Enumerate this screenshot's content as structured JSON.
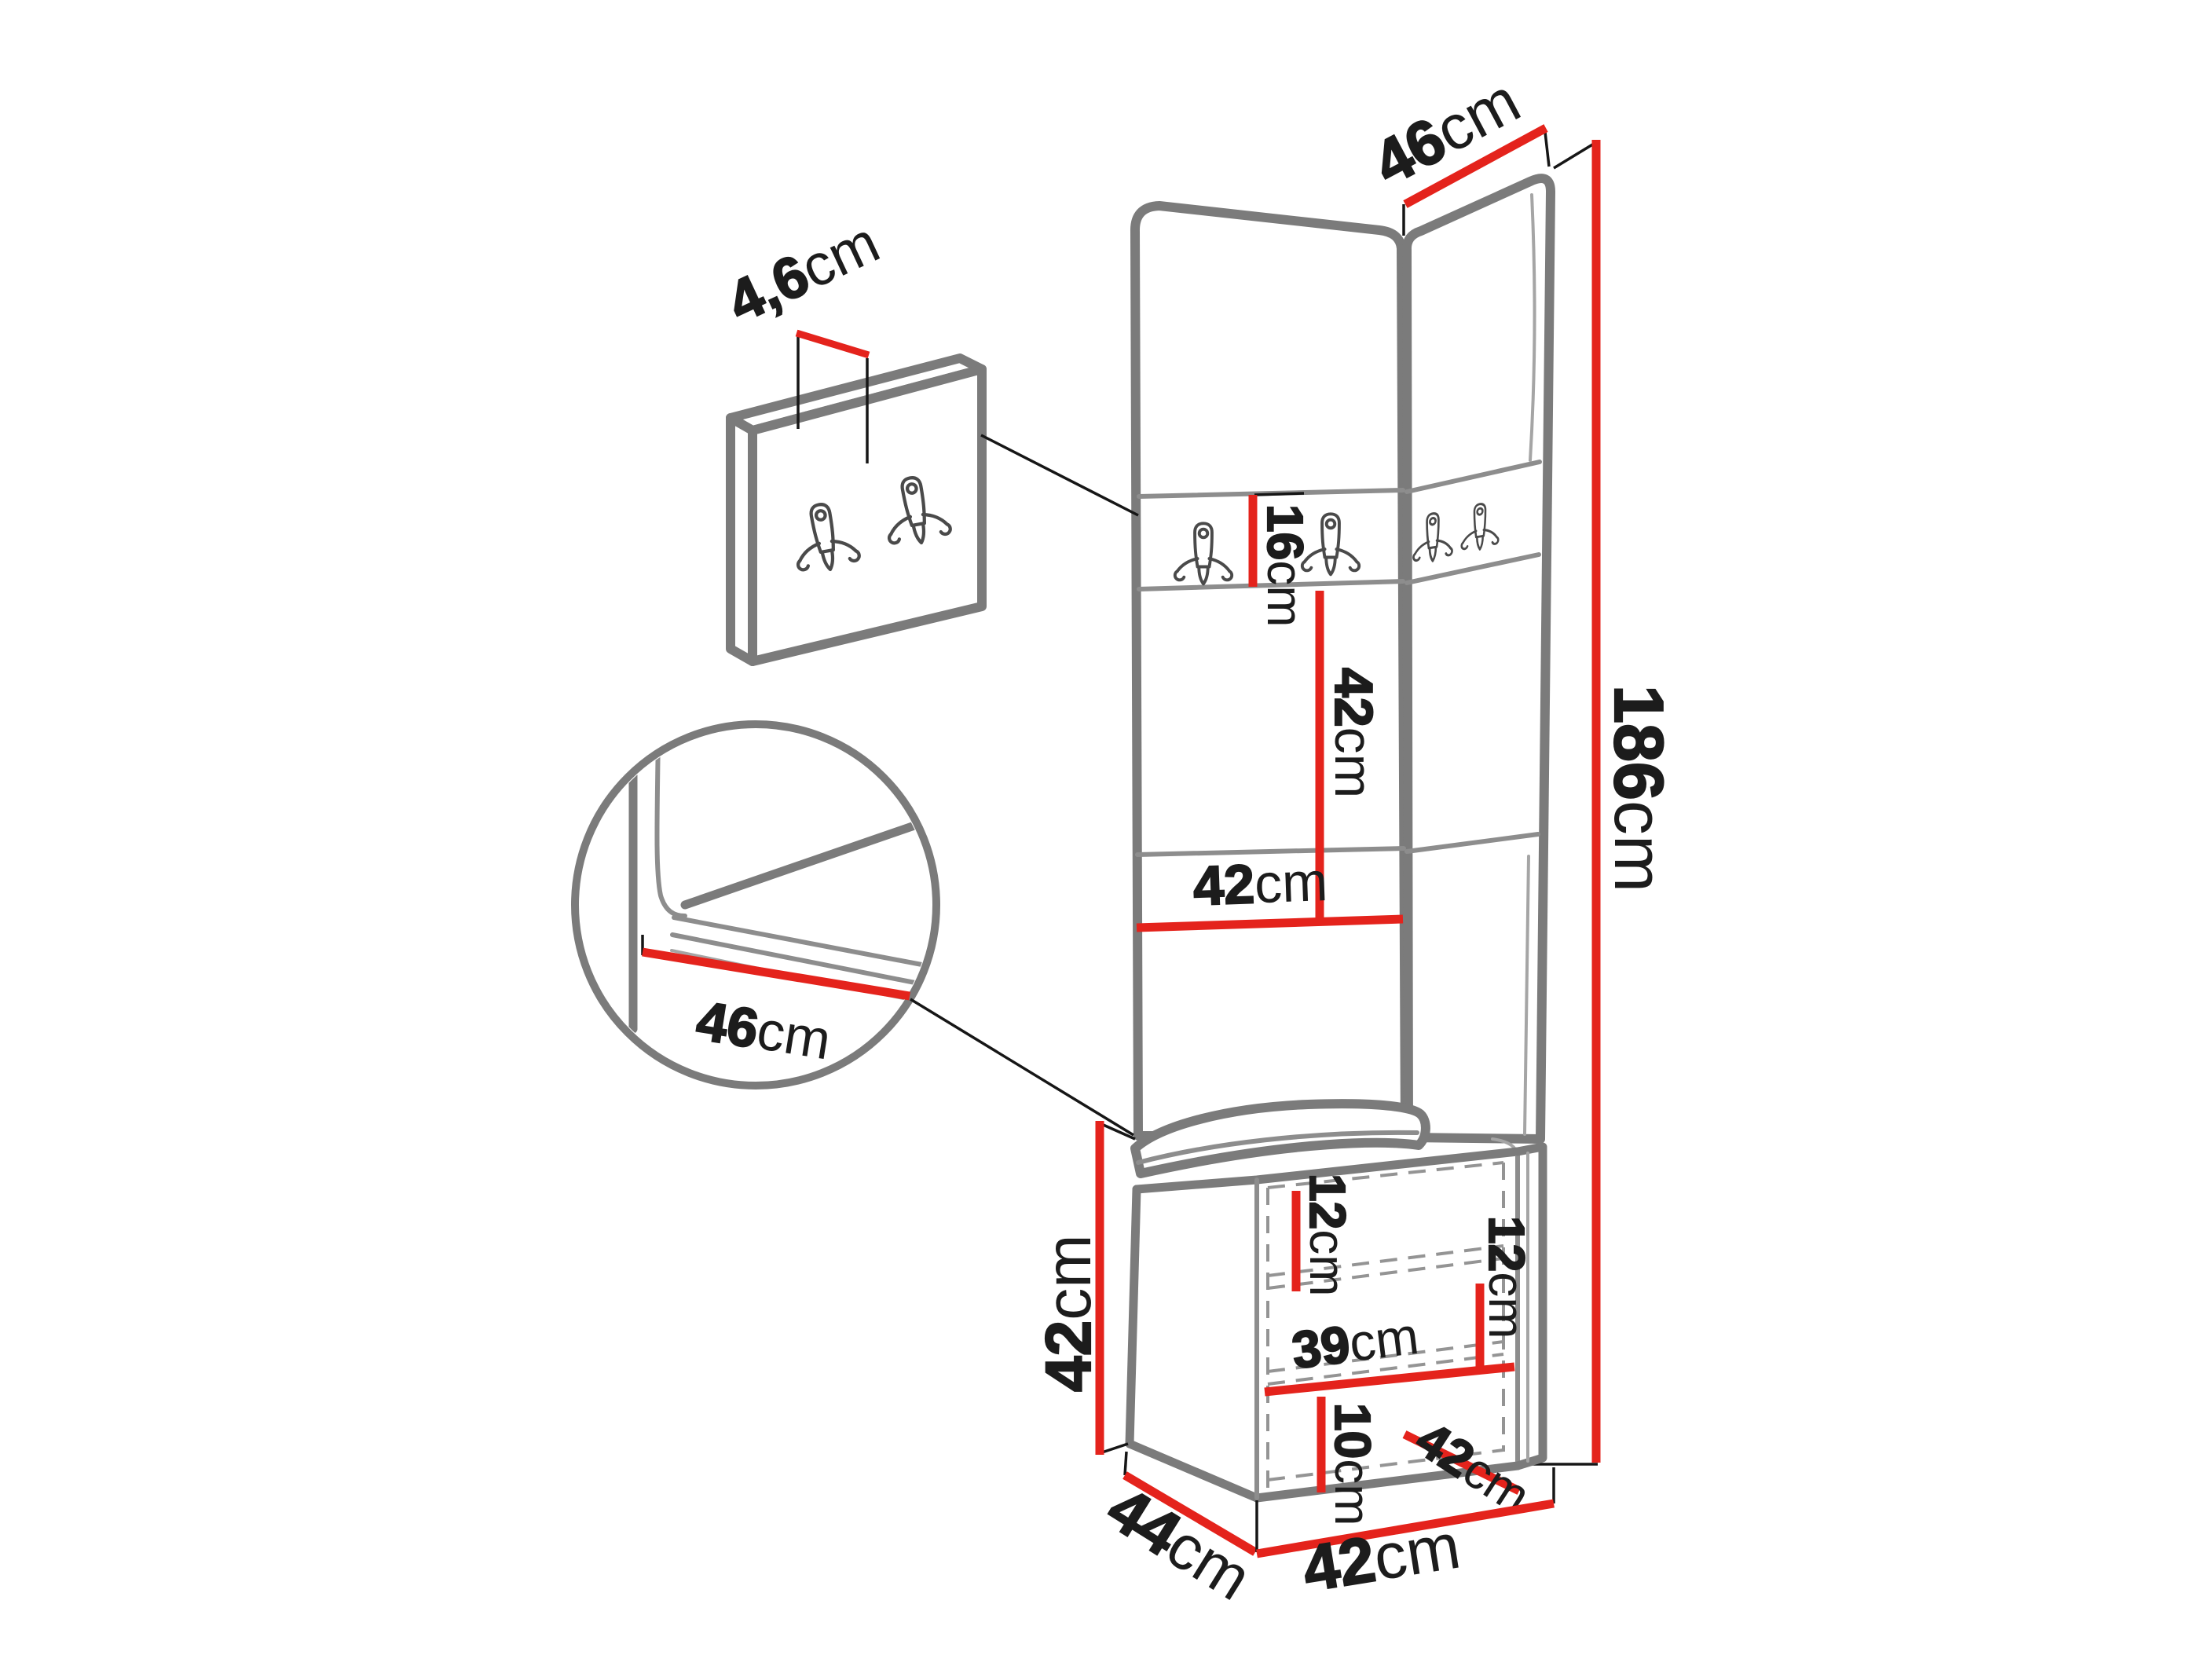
{
  "diagram": {
    "type": "furniture-dimension-diagram",
    "subject": "hallway corner panel set with coat hook strip, wall hook panel, bench cushion and shoe cabinet",
    "background": "#ffffff"
  },
  "colors": {
    "dimension_red": "#e4231c",
    "outline_gray": "#7b7b7b",
    "text_black": "#1c1c1c",
    "hidden_line_gray": "#949494"
  },
  "dimensions": {
    "hook_panel_thickness": {
      "value": "4,6",
      "unit": "cm"
    },
    "top_width": {
      "value": "46",
      "unit": "cm"
    },
    "hook_strip_height": {
      "value": "16",
      "unit": "cm"
    },
    "mid_panel_height": {
      "value": "42",
      "unit": "cm"
    },
    "mid_panel_width": {
      "value": "42",
      "unit": "cm"
    },
    "total_height": {
      "value": "186",
      "unit": "cm"
    },
    "seat_width_detail": {
      "value": "46",
      "unit": "cm"
    },
    "cabinet_height": {
      "value": "42",
      "unit": "cm"
    },
    "upper_shelf_gap": {
      "value": "12",
      "unit": "cm"
    },
    "right_shelf_gap": {
      "value": "12",
      "unit": "cm"
    },
    "interior_width": {
      "value": "39",
      "unit": "cm"
    },
    "lower_gap": {
      "value": "10",
      "unit": "cm"
    },
    "door_width": {
      "value": "42",
      "unit": "cm"
    },
    "cabinet_depth": {
      "value": "44",
      "unit": "cm"
    },
    "cabinet_width": {
      "value": "42",
      "unit": "cm"
    }
  }
}
